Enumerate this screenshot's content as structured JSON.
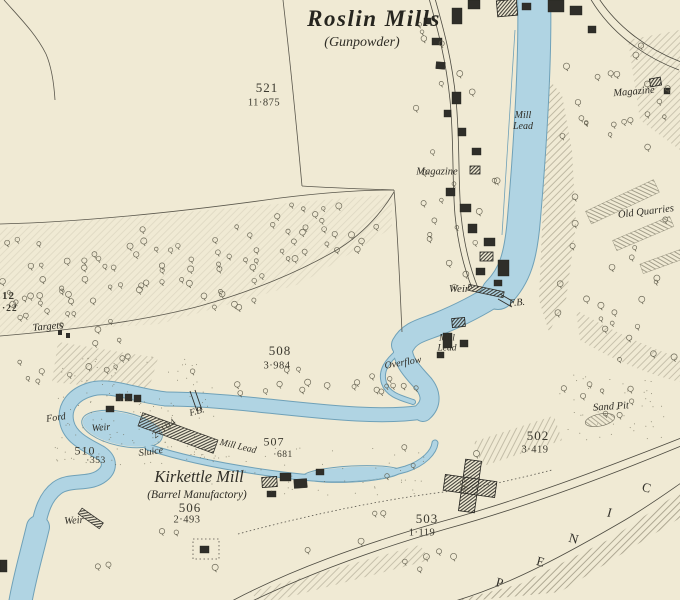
{
  "map": {
    "title": "Roslin Mills",
    "subtitle": "(Gunpowder)",
    "labels": {
      "magazine_upper": "Magazine",
      "magazine_right": "Magazine",
      "mill_lead_top": "Mill\nLead",
      "mill_lead_mid": "Mill\nLead",
      "mill_lead_channel": "Mill Lead",
      "old_quarries": "Old Quarries",
      "weir_center": "Weir",
      "weir_left": "Weir",
      "weir_bottom": "Weir",
      "fb_center": "F.B.",
      "fb_left": "F.B.",
      "overflow": "Overflow",
      "targets": "Targets",
      "ford": "Ford",
      "sluice": "Sluice",
      "sand_pit": "Sand Pit",
      "kirkettle_mill": "Kirkettle Mill",
      "barrel_manufactory": "(Barrel Manufactory)",
      "channel_area": "2·104",
      "edge_parcel_number": "12",
      "edge_parcel_area": "·22"
    },
    "parcels": [
      {
        "number": "521",
        "area": "11·875"
      },
      {
        "number": "508",
        "area": "3·984"
      },
      {
        "number": "510",
        "area": "·353"
      },
      {
        "number": "507",
        "area": "·681"
      },
      {
        "number": "506",
        "area": "2·493"
      },
      {
        "number": "503",
        "area": "1·119"
      },
      {
        "number": "502",
        "area": "3·419"
      }
    ],
    "boundary_letters": [
      "P",
      "E",
      "N",
      "I",
      "C"
    ],
    "colors": {
      "water": "#b0d4e3",
      "water_outline": "#6fa1b8",
      "background": "#f0ead4",
      "ink": "#2f2d26"
    }
  }
}
